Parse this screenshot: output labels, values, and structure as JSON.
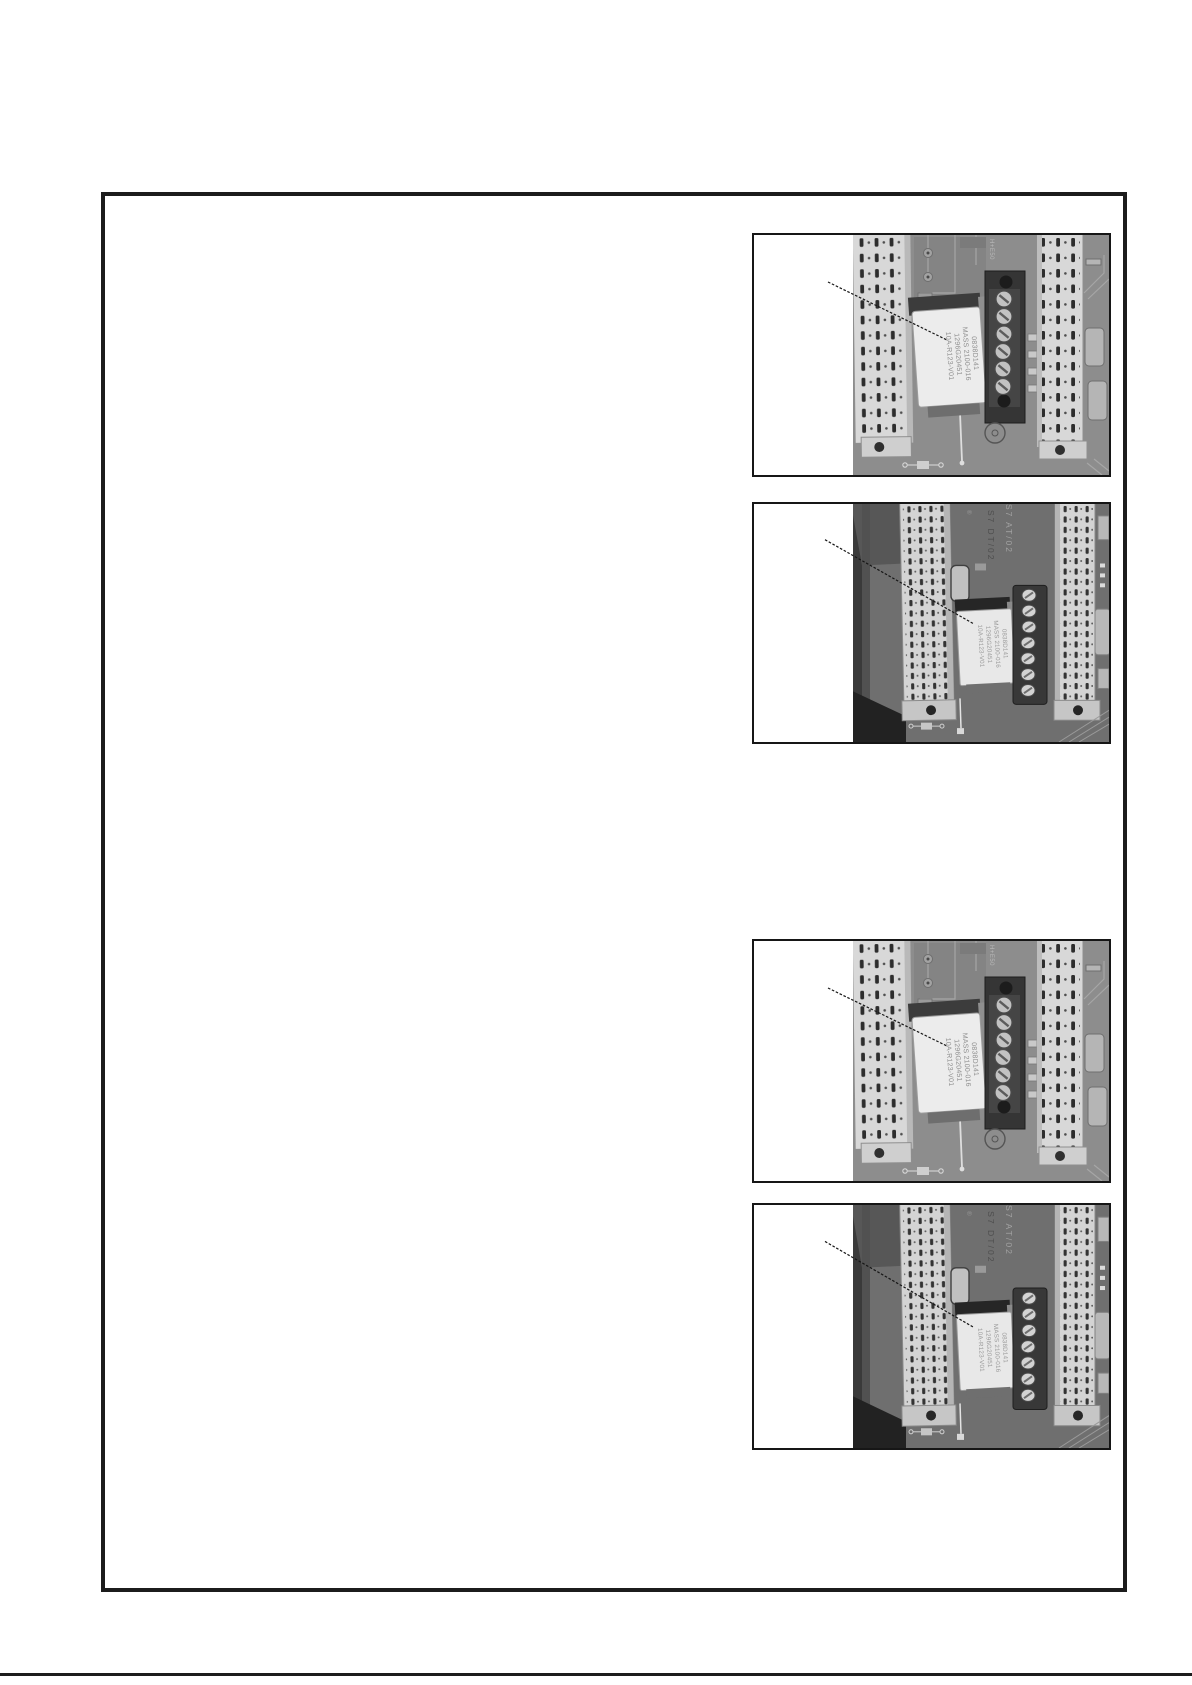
{
  "page": {
    "background": "#ffffff",
    "divider_color": "#1c1c1c"
  },
  "frame": {
    "border_color": "#1c1c1c"
  },
  "figures": [
    {
      "id": "photo-1",
      "callout_text": "",
      "relay_label_lines": [
        "0838D141",
        "MASS 2100-016",
        "1296G20451",
        "10A-R123-V01"
      ],
      "board_markings": [
        "H+E50"
      ]
    },
    {
      "id": "photo-2",
      "callout_text": "",
      "relay_label_lines": [
        "0838D141",
        "MASS 2100-016",
        "1296G20451",
        "10A-R123-V01"
      ],
      "board_markings": [
        "S7  AT/02",
        "S7  DT/02",
        "®"
      ]
    },
    {
      "id": "photo-3",
      "callout_text": "",
      "relay_label_lines": [
        "0838D141",
        "MASS 2100-016",
        "1296G20451",
        "10A-R123-V01"
      ],
      "board_markings": [
        "H+E50"
      ]
    },
    {
      "id": "photo-4",
      "callout_text": "",
      "relay_label_lines": [
        "0838D141",
        "MASS 2100-016",
        "1296G20451",
        "10A-R123-V01"
      ],
      "board_markings": [
        "S7  AT/02",
        "S7  DT/02",
        "®"
      ]
    }
  ],
  "colors": {
    "photo_light_board": "#8d8d8d",
    "photo_dark_board": "#6f6f6f",
    "connector_strip": "#d6d6d6",
    "relay_label": "#ececec",
    "terminal_block": "#383838"
  }
}
